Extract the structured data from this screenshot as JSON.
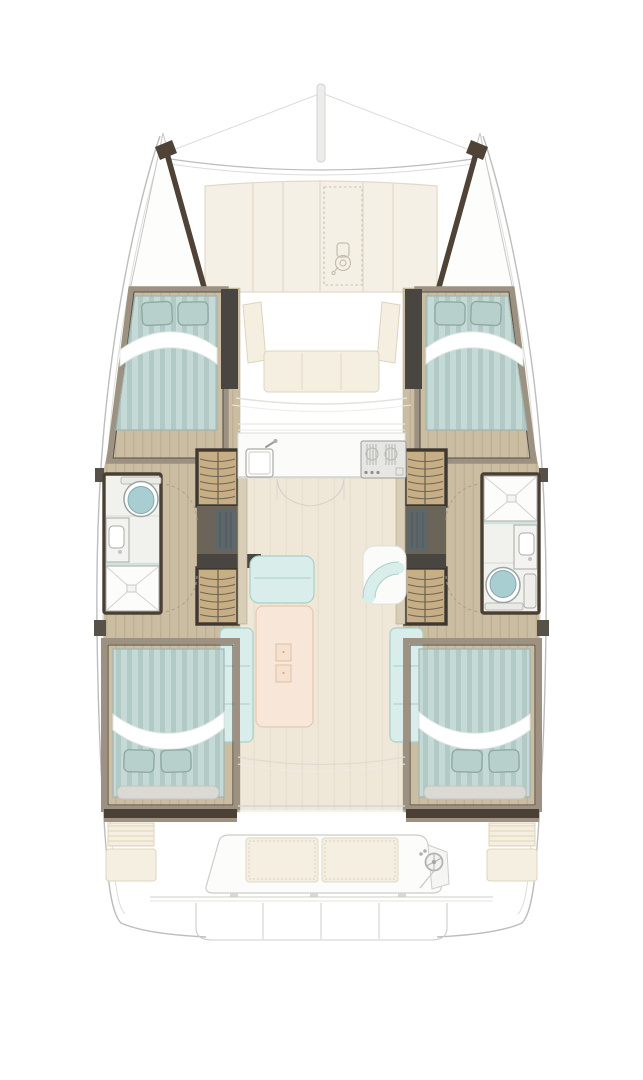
{
  "plan": {
    "type": "catamaran-deck-plan",
    "double_berths": 4,
    "bathrooms": 2,
    "showers": 2,
    "toilets": 2,
    "staircases": 4,
    "salon_tables": 1,
    "helm_stations": 1,
    "galley_sinks": 1,
    "stoves": 1,
    "forward_bench_cushions": 3,
    "aft_bench_cushions": 2
  },
  "icons": {
    "mast": "mast-icon",
    "windlass": "windlass-icon",
    "anchor_hatch": "hatch-dashed-icon",
    "galley_sink": "sink-icon",
    "stove": "stove-icon",
    "toilet": "toilet-icon",
    "shower": "shower-icon",
    "helm_wheel": "helm-wheel-icon",
    "door_swing": "door-arc-icon"
  },
  "palette": {
    "hullStroke": "#bdbdbd",
    "hullLight": "#dcdcda",
    "bowDark": "#4e4336",
    "deckCream": "#f5f0e6",
    "deckCreamEdge": "#e2dac7",
    "hatchDash": "#c9c2b2",
    "woodFloor": "#cbbda2",
    "woodGrain": "#bfb094",
    "cabinFrame": "#9d9281",
    "frameDark": "#57514a",
    "bulkheadDark": "#494540",
    "bedStripeA": "#c5dad6",
    "bedStripeB": "#b2cac6",
    "bedEdge": "#9fb6b2",
    "pillowFill": "#b7d0cc",
    "pillowEdge": "#8fa9a5",
    "sheetShadow": "#dfe7e5",
    "stairFrame": "#3e3831",
    "stairWood": "#c7ae84",
    "stairLine": "#6e6557",
    "landing": "#6b6459",
    "rugDark": "#5d6769",
    "bathFloor": "#f1f1ee",
    "bathWall": "#4a3f33",
    "fixtureLine": "#a9a9a4",
    "toiletTeal": "#a9ced2",
    "showerLine": "#c5c5c0",
    "tealGlass": "#cfe3e3",
    "sofaTeal": "#d9edeb",
    "sofaLine": "#a9cfcb",
    "tablePink": "#f8e6d8",
    "tableLine": "#e5c9b2",
    "salonFloor": "#efe8d8",
    "salonGrain": "#e7dfcc",
    "counterWhite": "#fbfbfa",
    "counterLine": "#dededa",
    "stoveFill": "#e6e6e3",
    "stoveLine": "#9a9a95",
    "cushionCream": "#f5efe2",
    "cushionEdge": "#ddd4bf",
    "stripeCushion": "#ece2cc",
    "cockpitLine": "#cccccb",
    "arcDash": "#a89e8e",
    "benchGray": "#dbd9d4"
  }
}
